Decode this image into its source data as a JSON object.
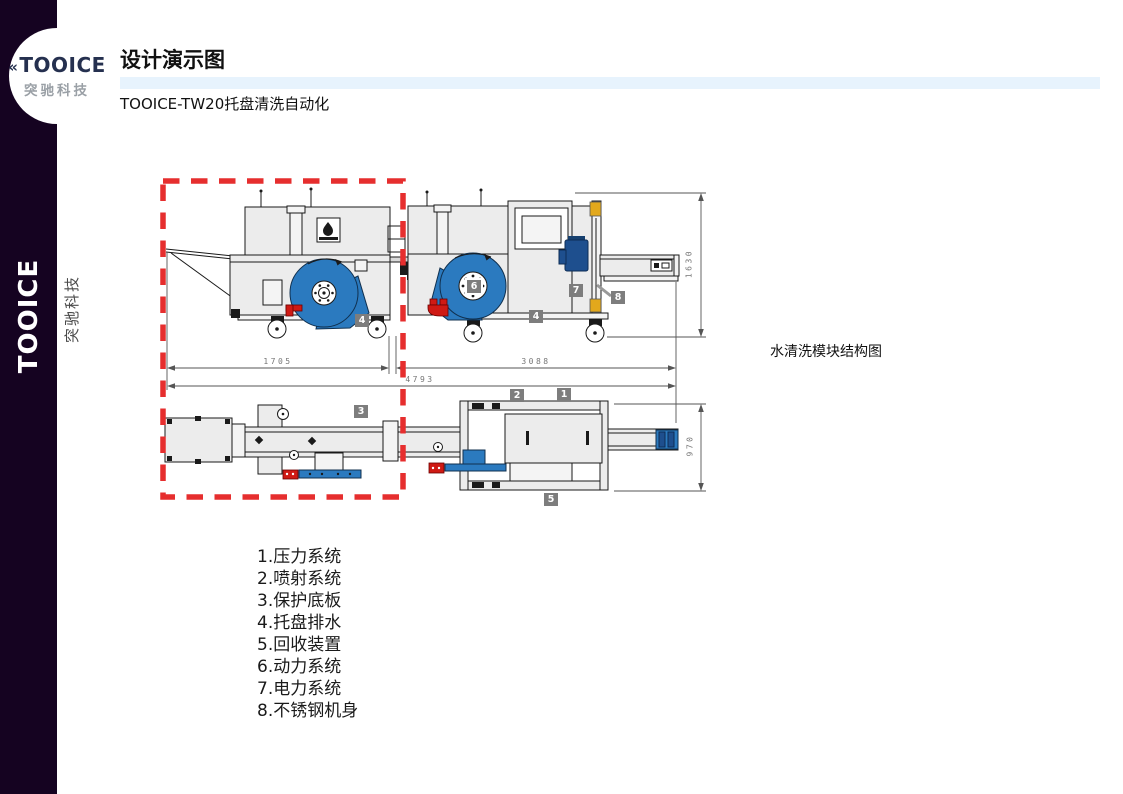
{
  "brand": {
    "name": "TOOICE",
    "tagline": "突驰科技",
    "mark": "«"
  },
  "sidebar": {
    "vertical_brand": "TOOICE",
    "vertical_tagline": "突驰科技"
  },
  "header": {
    "title": "设计演示图",
    "subtitle": "TOOICE-TW20托盘清洗自动化"
  },
  "diagram": {
    "caption": "水清洗模块结构图",
    "dims": {
      "left_span": "1705",
      "right_span": "3088",
      "total_span": "4793",
      "side_height": "1630",
      "plan_height": "970"
    },
    "badges": {
      "b1": "1",
      "b2": "2",
      "b3": "3",
      "b4a": "4",
      "b4b": "4",
      "b5": "5",
      "b6": "6",
      "b7": "7",
      "b8": "8"
    },
    "colors": {
      "machine": "#ececec",
      "blower_blue": "#2b7abf",
      "motor_blue": "#1e4f8e",
      "accent_red": "#cf1a14",
      "accent_yellow": "#e2a81c",
      "highlight_red": "#e62e2e",
      "badge_gray": "#7d7d7d",
      "sidebar_bg": "#150321",
      "title_accent": "#e7f3fd"
    }
  },
  "legend": {
    "items": [
      "1.压力系统",
      "2.喷射系统",
      "3.保护底板",
      "4.托盘排水",
      "5.回收装置",
      "6.动力系统",
      "7.电力系统",
      "8.不锈钢机身"
    ]
  }
}
